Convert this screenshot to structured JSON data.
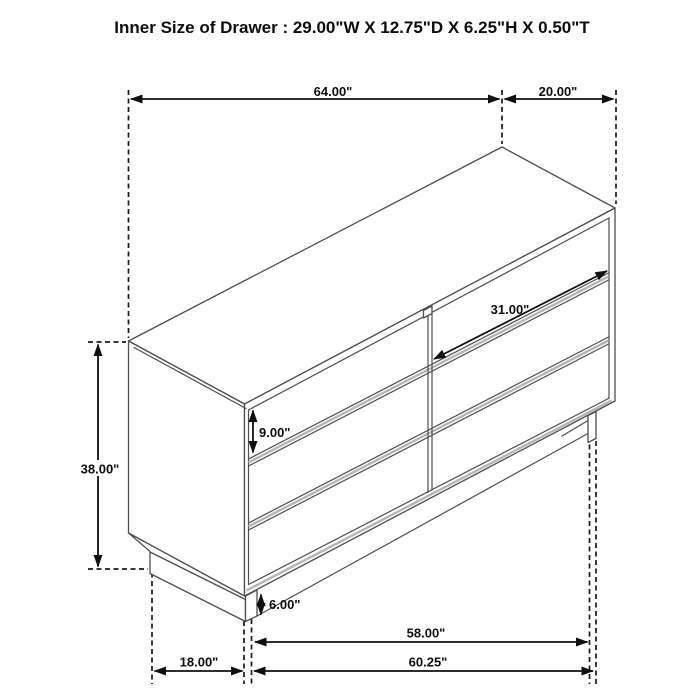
{
  "title": "Inner Size of Drawer : 29.00\"W X 12.75\"D X 6.25\"H X 0.50\"T",
  "dimensions": {
    "top_width": "64.00\"",
    "top_depth": "20.00\"",
    "drawer_width": "31.00\"",
    "drawer_face_height": "9.00\"",
    "overall_height": "38.00\"",
    "base_height": "6.00\"",
    "inner_leg_span": "58.00\"",
    "front_width": "60.25\"",
    "side_depth": "18.00\""
  }
}
